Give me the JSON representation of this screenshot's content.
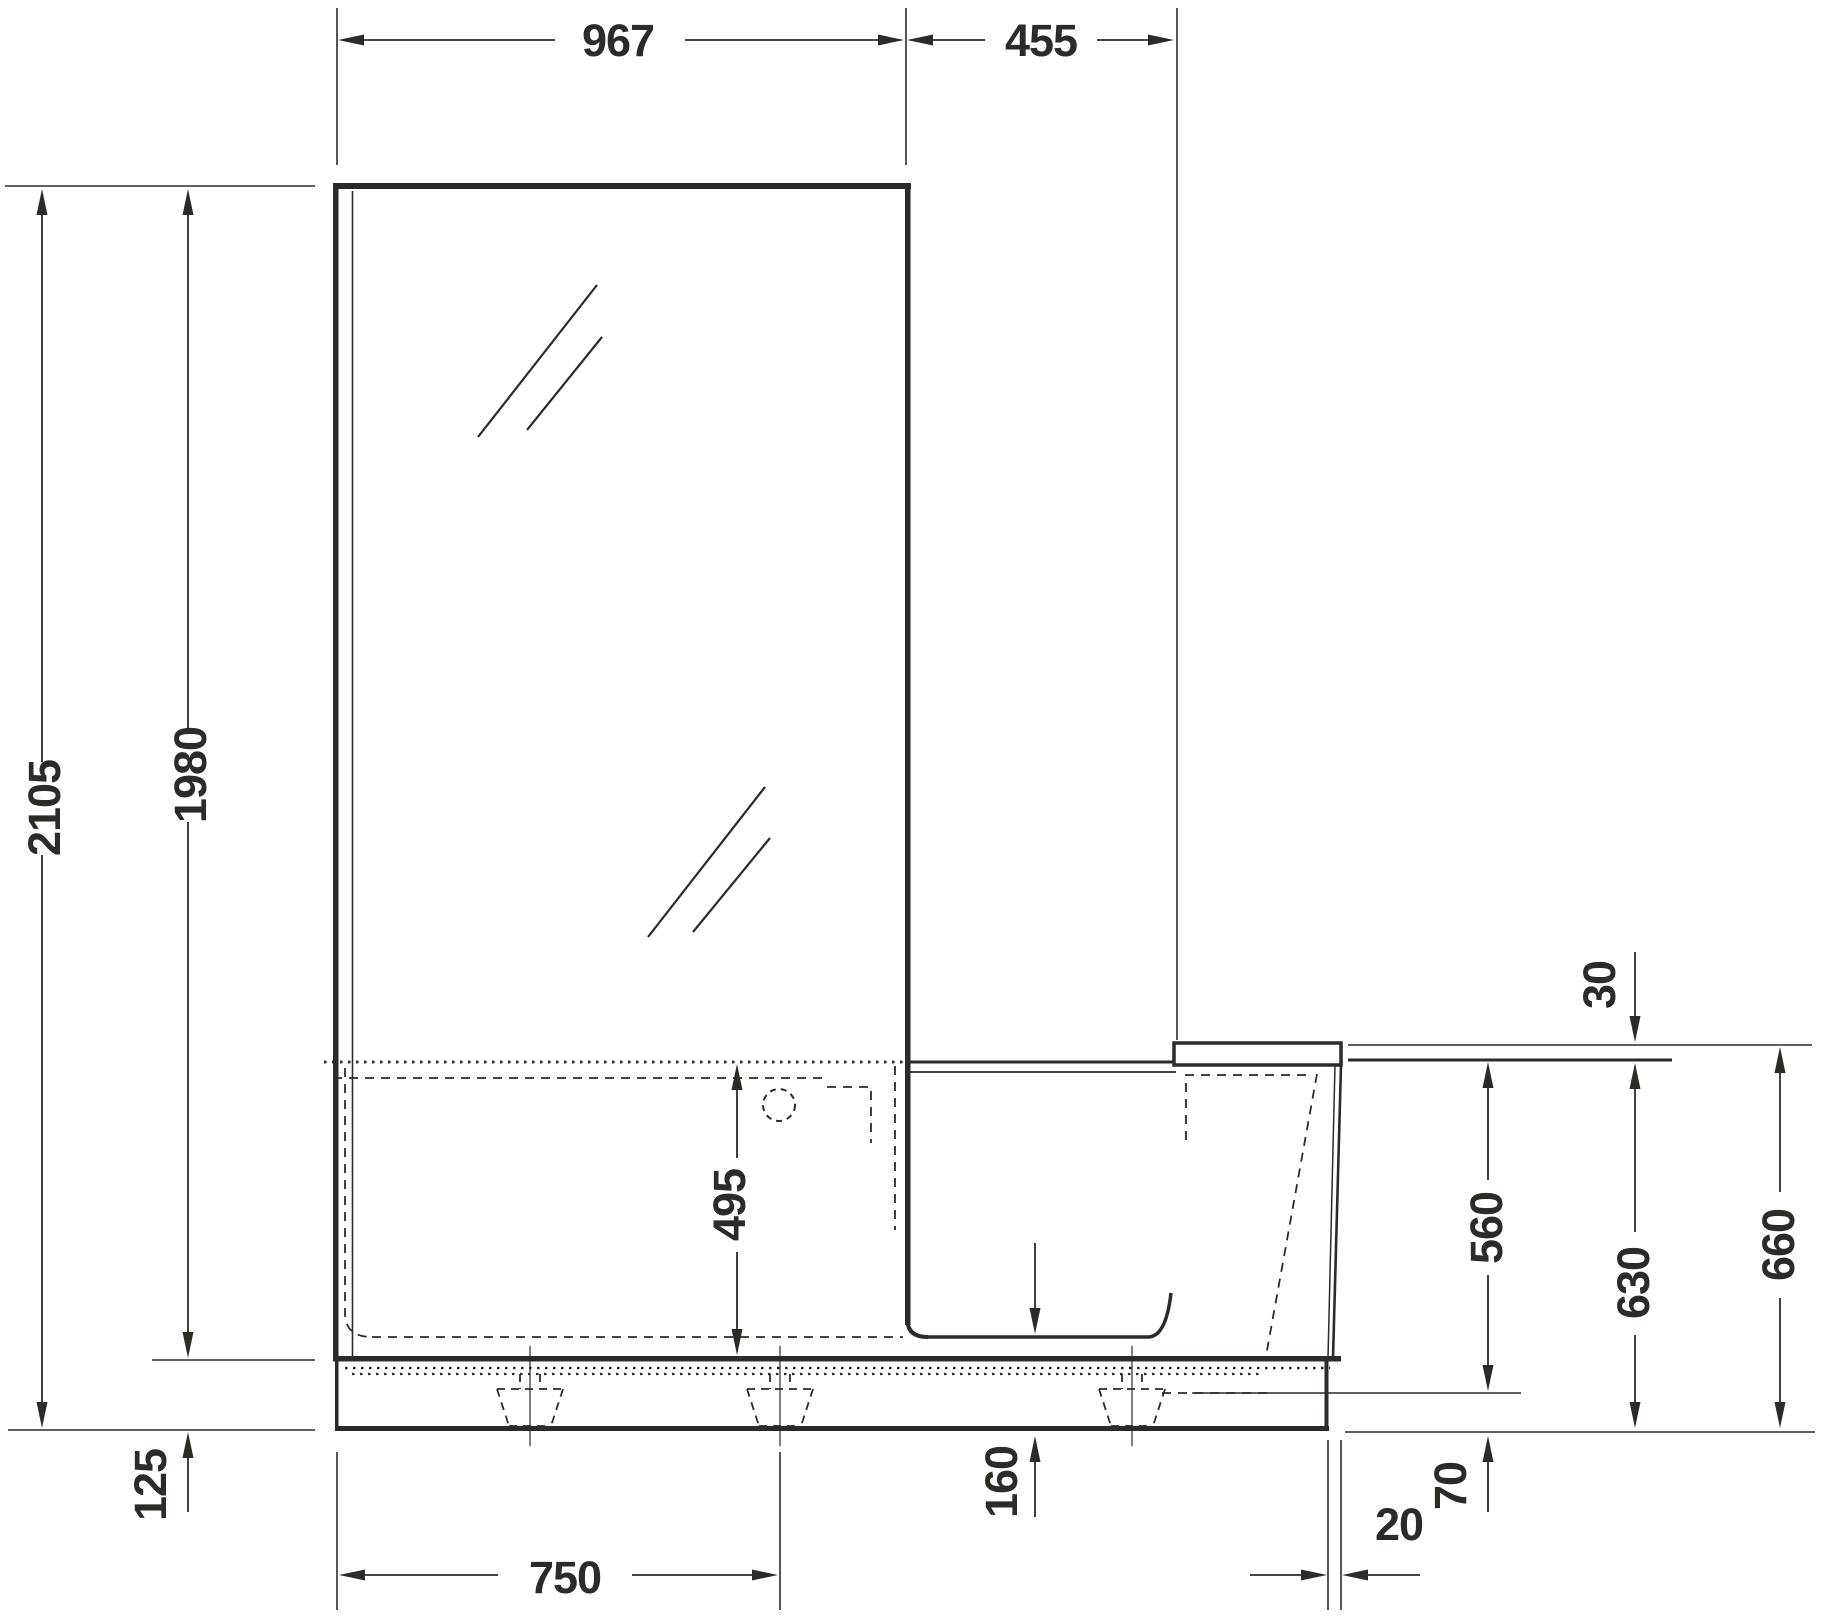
{
  "drawing": {
    "kind": "bathtub-with-shower-screen-side-elevation",
    "colors": {
      "line": "#2b2b28",
      "background": "#ffffff"
    }
  },
  "dims": {
    "glass_width": "967",
    "door_section_width": "455",
    "total_height": "2105",
    "glass_height": "1980",
    "base_height": "125",
    "tub_inner_depth": "495",
    "seat_step": "30",
    "rim_to_shower_floor": "560",
    "rim_height": "630",
    "seat_surface_height": "660",
    "tub_floor_height": "160",
    "shower_floor_height": "70",
    "panel_offset": "20",
    "foot_spacing": "750"
  }
}
